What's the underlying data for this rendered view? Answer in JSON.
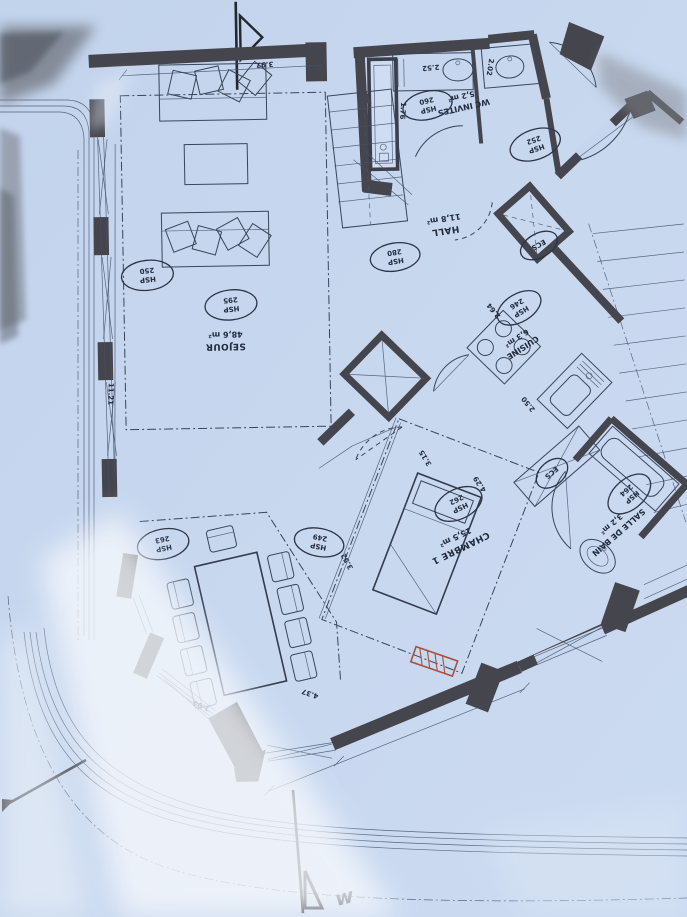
{
  "document": {
    "kind": "scanned architectural floor plan, drawing rotated 180°"
  },
  "colors": {
    "paper": "#c6d6ee",
    "ink": "#2c3547",
    "wall": "#45454d",
    "radiator_red": "#a8503a"
  },
  "rooms": {
    "sejour": {
      "name": "SEJOUR",
      "area": "48,6 m²",
      "hsp_label": "HSP",
      "hsp_value": "295"
    },
    "hall": {
      "name": "HALL",
      "area": "11,8 m²",
      "hsp_label": "HSP",
      "hsp_value": "280"
    },
    "wc_invites": {
      "name": "WC INVITES",
      "area": "5,2 m²",
      "hsp_label": "HSP",
      "hsp_value": "260"
    },
    "cuisine": {
      "name": "CUISINE",
      "area": "6,3 m²",
      "hsp_label": "HSP",
      "hsp_value": "246"
    },
    "chambre": {
      "name": "CHAMBRE 1",
      "area": "15,5 m²",
      "hsp_label": "HSP",
      "hsp_value": "262"
    },
    "salle_de_bain": {
      "name": "SALLE DE BAIN",
      "area": "3,2 m²",
      "hsp_label": "HSP",
      "hsp_value": "264"
    }
  },
  "hsp_markers": {
    "terrace": {
      "label": "HSP",
      "value": "250"
    },
    "wc_right": {
      "label": "HSP",
      "value": "252"
    },
    "dining_left": {
      "label": "HSP",
      "value": "263"
    },
    "dining_right": {
      "label": "HSP",
      "value": "249"
    }
  },
  "ecs": {
    "upper": "ECS",
    "lower": "ECS"
  },
  "dimensions": {
    "top": "3.97",
    "left_height": "11.21",
    "wc_counter": "2.52",
    "wc_width": "1.76",
    "toilet_room": "2.02",
    "kitchen_depth": "2.64",
    "kitchen_width": "2.50",
    "chambre_width": "3.15",
    "chambre_length": "4.29",
    "dining_edge": "3.52",
    "bottom_edge": "4.37",
    "corner_edge": "1.94"
  },
  "section_note": "w"
}
